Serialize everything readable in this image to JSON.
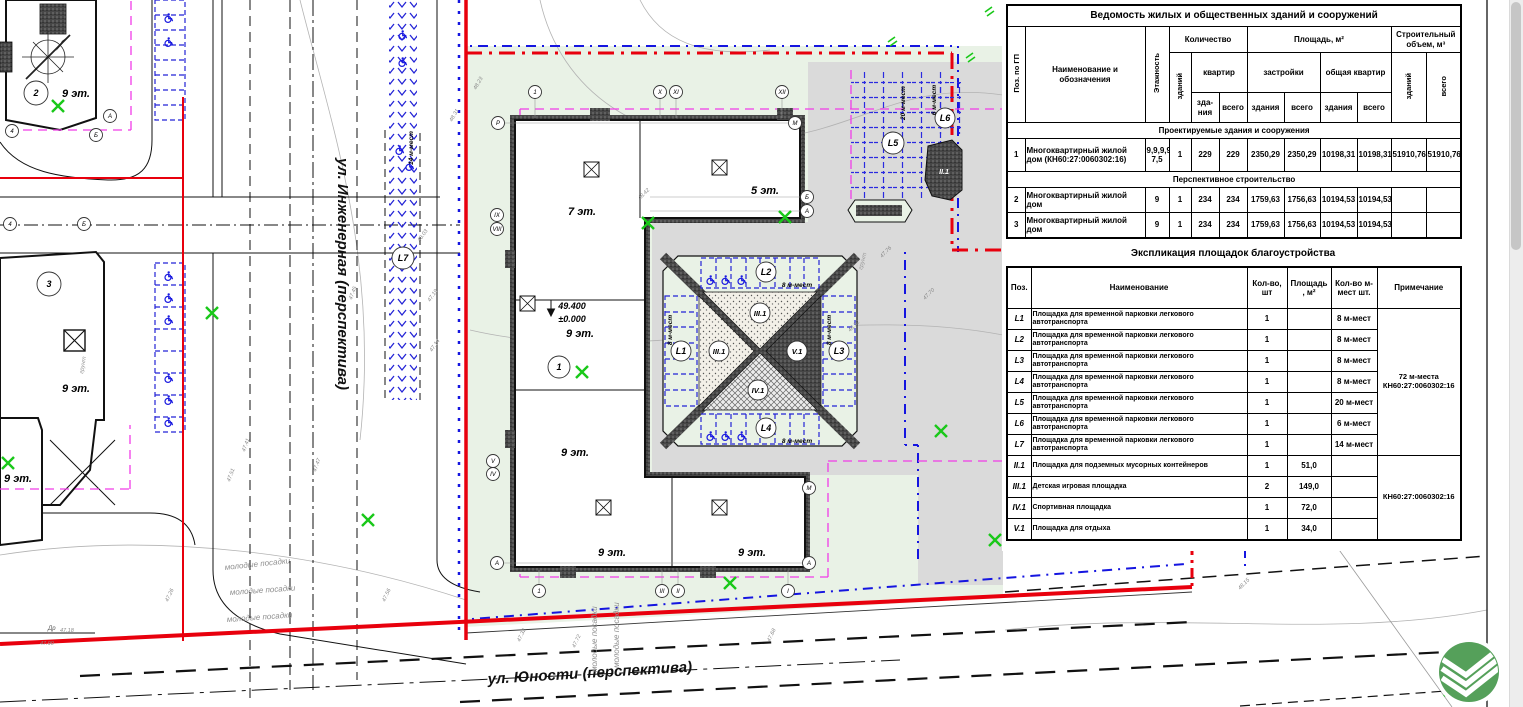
{
  "buildings_table": {
    "title": "Ведомость жилых и общественных зданий и сооружений",
    "h": {
      "pos": "Поз. по ГП",
      "name": "Наименование и обозначения",
      "floors": "Этажность",
      "qty": "Количество",
      "bld": "зданий",
      "flats": "квартир",
      "flats_b": "зда- ния",
      "flats_t": "всего",
      "area": "Площадь, м²",
      "built": "застройки",
      "built_b": "здания",
      "built_t": "всего",
      "total_flats": "общая квартир",
      "tf_b": "здания",
      "tf_t": "всего",
      "vol": "Строительный объем, м³",
      "vol_b": "зданий",
      "vol_t": "всего"
    },
    "sec1": "Проектируемые здания и сооружения",
    "sec2": "Перспективное строительство",
    "rows": [
      {
        "c": [
          "1",
          "Многоквартирный жилой дом (КН60:27:0060302:16)",
          "9,9,9,9, 7,5",
          "1",
          "229",
          "229",
          "2350,29",
          "2350,29",
          "10198,31",
          "10198,31",
          "51910,76",
          "51910,76"
        ]
      },
      {
        "c": [
          "2",
          "Многоквартирный жилой дом",
          "9",
          "1",
          "234",
          "234",
          "1759,63",
          "1756,63",
          "10194,53",
          "10194,53",
          "",
          ""
        ]
      },
      {
        "c": [
          "3",
          "Многоквартирный жилой дом",
          "9",
          "1",
          "234",
          "234",
          "1759,63",
          "1756,63",
          "10194,53",
          "10194,53",
          "",
          ""
        ]
      }
    ]
  },
  "landscaping_table": {
    "title": "Экспликация площадок благоустройства",
    "h": {
      "pos": "Поз.",
      "name": "Наименование",
      "qty": "Кол-во, шт",
      "area": "Площадь , м²",
      "spaces": "Кол-во м-мест шт.",
      "note": "Примечание"
    },
    "rows": [
      {
        "c": [
          "L1",
          "Площадка для временной парковки легкового автотранспорта",
          "1",
          "",
          "8 м-мест"
        ]
      },
      {
        "c": [
          "L2",
          "Площадка для временной парковки легкового автотранспорта",
          "1",
          "",
          "8 м-мест"
        ]
      },
      {
        "c": [
          "L3",
          "Площадка для временной парковки легкового автотранспорта",
          "1",
          "",
          "8 м-мест"
        ]
      },
      {
        "c": [
          "L4",
          "Площадка для временной парковки легкового автотранспорта",
          "1",
          "",
          "8 м-мест"
        ]
      },
      {
        "c": [
          "L5",
          "Площадка для временной парковки легкового автотранспорта",
          "1",
          "",
          "20 м-мест"
        ]
      },
      {
        "c": [
          "L6",
          "Площадка для временной парковки легкового автотранспорта",
          "1",
          "",
          "6 м-мест"
        ]
      },
      {
        "c": [
          "L7",
          "Площадка для временной парковки легкового автотранспорта",
          "1",
          "",
          "14 м-мест"
        ]
      },
      {
        "c": [
          "II.1",
          "Площадка для подземных мусорных контейнеров",
          "1",
          "51,0",
          ""
        ]
      },
      {
        "c": [
          "III.1",
          "Детская игровая площадка",
          "2",
          "149,0",
          ""
        ]
      },
      {
        "c": [
          "IV.1",
          "Спортивная площадка",
          "1",
          "72,0",
          ""
        ]
      },
      {
        "c": [
          "V.1",
          "Площадка для отдыха",
          "1",
          "34,0",
          ""
        ]
      }
    ],
    "note_parking": "72 м-места КН60:27:0060302:16",
    "note_areas": "КН60:27:0060302:16"
  },
  "plan": {
    "street_left": "ул. Инженерная (перспектива)",
    "street_bottom": "ул. Юности (перспектива)",
    "planting_label": "молодые посадки",
    "ground_label": "грунт",
    "dr_label": "Др",
    "building1": {
      "num": "1",
      "elev_roof": "49.400",
      "elev_zero": "±0.000",
      "wing_top_left": "7 эт.",
      "wing_top_right": "5 эт.",
      "wing_left": "9 эт.",
      "wing_left2": "9 эт.",
      "wing_bottom_a": "9 эт.",
      "wing_bottom_b": "9 эт."
    },
    "building2": {
      "num": "2",
      "floors": "9 эт."
    },
    "building3": {
      "num": "3",
      "floors": "9 эт."
    },
    "building_edge_floors": "9 эт.",
    "parking": {
      "l1": "L1",
      "l2": "L2",
      "l3": "L3",
      "l4": "L4",
      "l5": "L5",
      "l6": "L6",
      "l7": "L7",
      "cap8": "8 м-мест",
      "cap20": "20 м-мест",
      "cap6": "6 м-мест",
      "cap14": "14 м-мест"
    },
    "areas": {
      "ii1": "II.1",
      "iii1": "III.1",
      "iv1": "IV.1",
      "v1": "V.1"
    },
    "axis": {
      "n1": "1",
      "nx": "Х",
      "nxi": "ХI",
      "nxii": "ХII",
      "p": "Р",
      "m": "М",
      "b": "Б",
      "a": "А",
      "ix": "IX",
      "viii": "VIII",
      "v": "V",
      "iv": "IV",
      "iii": "III",
      "ii": "II",
      "i": "I",
      "n4": "4"
    },
    "spots": [
      "48.23",
      "48.31",
      "48.03",
      "47.19",
      "47.14",
      "47.41",
      "47.51",
      "47.47",
      "47.45",
      "48.42",
      "48.12",
      "47.76",
      "47.70",
      "47.18",
      "47.26",
      "47.56",
      "47.32",
      "47.72",
      "47.68",
      "48.15",
      "48.63",
      "47.90"
    ]
  }
}
